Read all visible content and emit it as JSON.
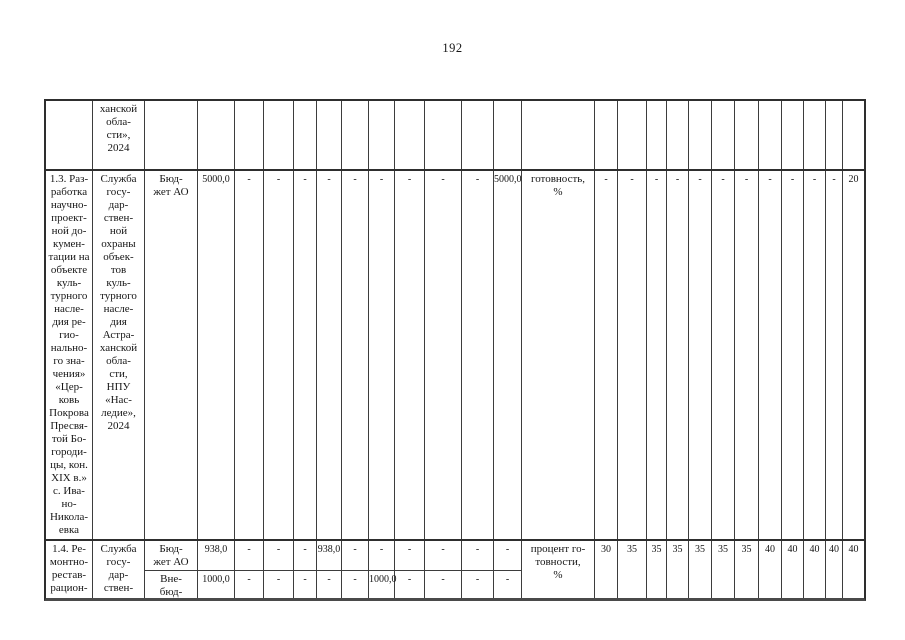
{
  "page": {
    "number": "192"
  },
  "table": {
    "continuation_row": {
      "executor": "ханской\nобла-\nсти»,\n2024"
    },
    "row_1_3": {
      "activity": "1.3. Раз-\nработка\nнаучно-\nпроект-\nной до-\nкумен-\nтации на\nобъекте\nкуль-\nтурного\nнасле-\nдия ре-\nгио-\nнально-\nго зна-\nчения»\n«Цер-\nковь\nПокрова\nПресвя-\nтой Бо-\nгороди-\nцы, кон.\nXIX в.»\nс. Ива-\nно-\nНикола-\nевка",
      "executor": "Служба\nгосу-\nдар-\nствен-\nной\nохраны\nобъек-\nтов\nкуль-\nтурного\nнасле-\nдия\nАстра-\nханской\nобла-\nсти,\nНПУ\n«Нас-\nледие»,\n2024",
      "funding_source": "Бюд-\nжет АО",
      "amounts": [
        "5000,0",
        "-",
        "-",
        "-",
        "-",
        "-",
        "-",
        "-",
        "-",
        "-",
        "5000,0"
      ],
      "indicator": "готовность,\n%",
      "values": [
        "-",
        "-",
        "-",
        "-",
        "-",
        "-",
        "-",
        "-",
        "-",
        "-",
        "-",
        "20"
      ]
    },
    "row_1_4": {
      "activity": "1.4. Ре-\nмонтно-\nрестав-\nрацион-",
      "executor": "Служба\nгосу-\nдар-\nствен-",
      "sub_rows": [
        {
          "funding_source": "Бюд-\nжет АО",
          "amounts": [
            "938,0",
            "-",
            "-",
            "-",
            "938,0",
            "-",
            "-",
            "-",
            "-",
            "-",
            "-"
          ]
        },
        {
          "funding_source": "Вне-\nбюд-",
          "amounts": [
            "1000,0",
            "-",
            "-",
            "-",
            "-",
            "-",
            "1000,0",
            "-",
            "-",
            "-",
            "-"
          ]
        }
      ],
      "indicator": "процент го-\nтовности,\n%",
      "values": [
        "30",
        "35",
        "35",
        "35",
        "35",
        "35",
        "35",
        "40",
        "40",
        "40",
        "40",
        "40"
      ]
    }
  }
}
